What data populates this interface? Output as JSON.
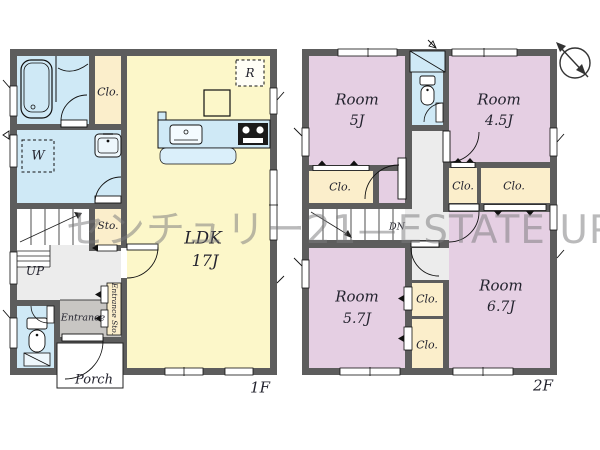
{
  "watermark": "センチュリー21—ESTATE UP",
  "floor1": {
    "label": "1F",
    "ldk_name": "LDK",
    "ldk_size": "17J",
    "closet": "Clo.",
    "storage": "Sto.",
    "entrance": "Entrance",
    "entrance_storage": "Entrance Sto.",
    "porch": "Porch",
    "stairs": "UP",
    "refrigerator": "R",
    "washer": "W"
  },
  "floor2": {
    "label": "2F",
    "rooms": [
      {
        "name": "Room",
        "size": "5J"
      },
      {
        "name": "Room",
        "size": "4.5J"
      },
      {
        "name": "Room",
        "size": "5.7J"
      },
      {
        "name": "Room",
        "size": "6.7J"
      }
    ],
    "closet": "Clo.",
    "stairs": "DN"
  },
  "colors": {
    "wall": "#5d5d5d",
    "room_pink": "#e5cfe3",
    "ldk_yellow": "#fcf7c9",
    "water_blue": "#cfe9f6",
    "closet_beige": "#fbeecb",
    "entrance_gray": "#c8c6c3",
    "hall_gray": "#ececec"
  }
}
